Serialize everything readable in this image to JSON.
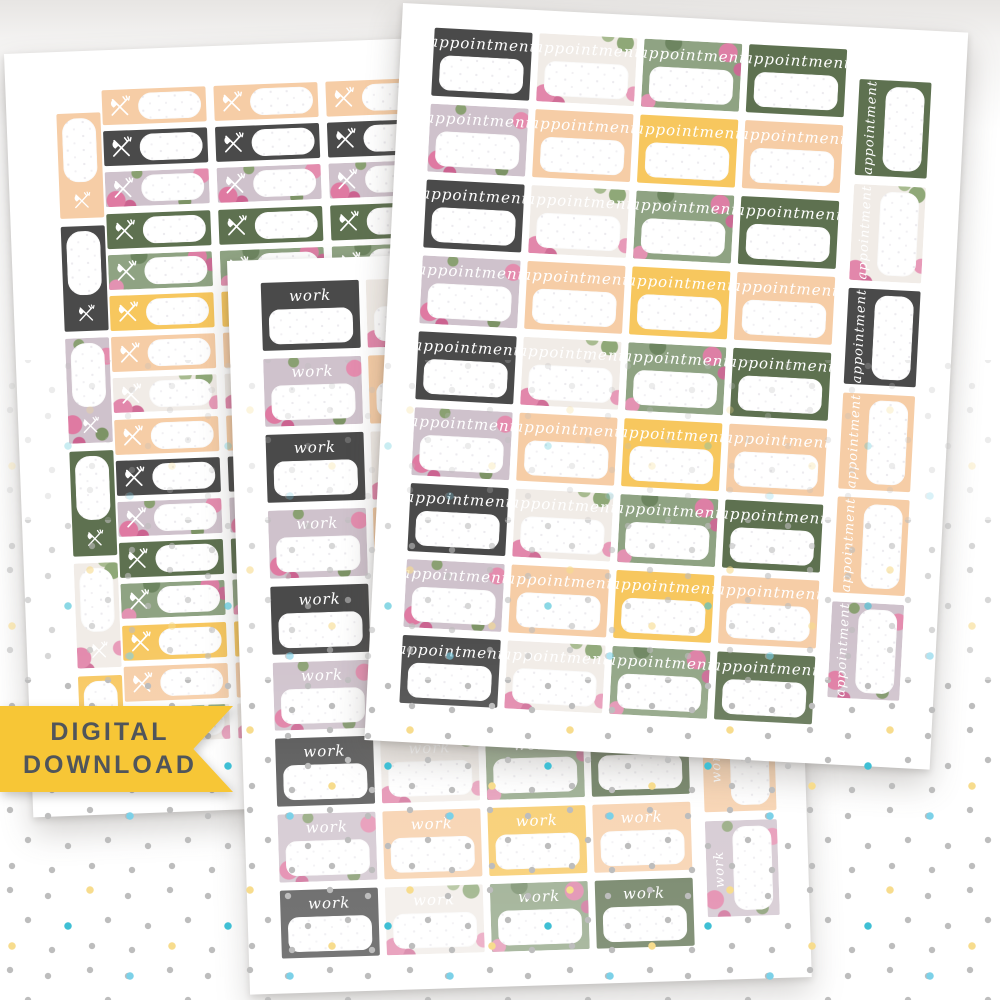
{
  "banner": {
    "line1": "DIGITAL",
    "line2": "DOWNLOAD"
  },
  "palette": {
    "paper": "#ffffff",
    "dark": "#4a4a4a",
    "green": "#5e7150",
    "sfloral": "#8fa383",
    "wfloral": "#f1ece7",
    "lavender": "#cfc2cc",
    "peach": "#f6cda6",
    "yellow": "#f7c75e",
    "rose": "#df7aa2",
    "leaf": "#7d9366",
    "banner-bg": "#f7c636",
    "banner-text": "#50555b"
  },
  "dots": {
    "gray": "#bdbdbd",
    "yellow": "#f7dc8d",
    "blue": "#7cd1e8",
    "teal": "#3fbfd4"
  },
  "sheets": {
    "appointment": {
      "label": "appointment",
      "rows": 9,
      "row_odd": [
        "dark",
        "wfloral",
        "sfloral",
        "green"
      ],
      "row_even": [
        "lavender",
        "peach",
        "yellow",
        "peach"
      ],
      "side_column": [
        "green",
        "wfloral",
        "dark",
        "peach",
        "peach",
        "lavender"
      ]
    },
    "work": {
      "label": "work",
      "rows": 9,
      "row_odd": [
        "dark",
        "wfloral",
        "sfloral",
        "green"
      ],
      "row_even": [
        "lavender",
        "peach",
        "yellow",
        "peach"
      ],
      "side_column": [
        "green",
        "wfloral",
        "dark",
        "peach",
        "peach",
        "lavender"
      ]
    },
    "meal": {
      "icon": "utensils-icon",
      "side_column": [
        "peach",
        "dark",
        "lavender",
        "green",
        "wfloral",
        "yellow"
      ],
      "strip_cycle": [
        "peach",
        "dark",
        "lavender",
        "green",
        "sfloral",
        "yellow",
        "peach",
        "wfloral"
      ],
      "strip_cols": 3,
      "strip_rows": 16
    }
  }
}
